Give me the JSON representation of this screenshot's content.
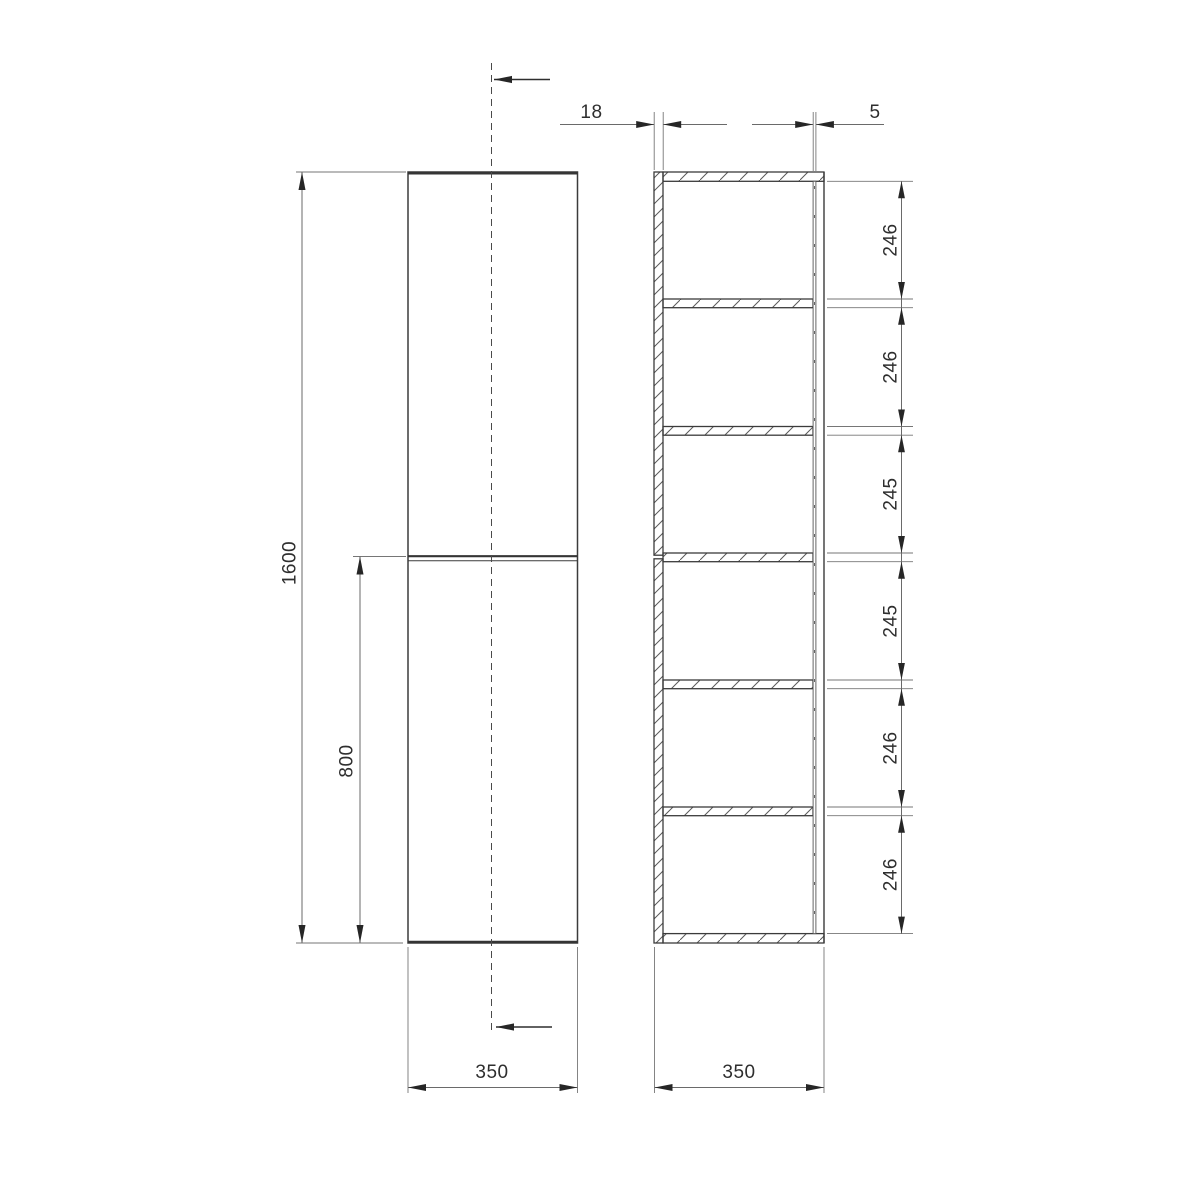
{
  "front_view": {
    "height_label": "1600",
    "door_split_label": "800",
    "width_label": "350"
  },
  "section_view": {
    "panel_thickness_label": "18",
    "back_panel_thickness_label": "5",
    "depth_label": "350",
    "opening_labels": [
      "246",
      "246",
      "245",
      "245",
      "246",
      "246"
    ]
  },
  "colors": {
    "outline": "#3b3b3b",
    "dimension_line": "#6a6a6a",
    "text": "#2e2e2e",
    "background": "#ffffff"
  }
}
